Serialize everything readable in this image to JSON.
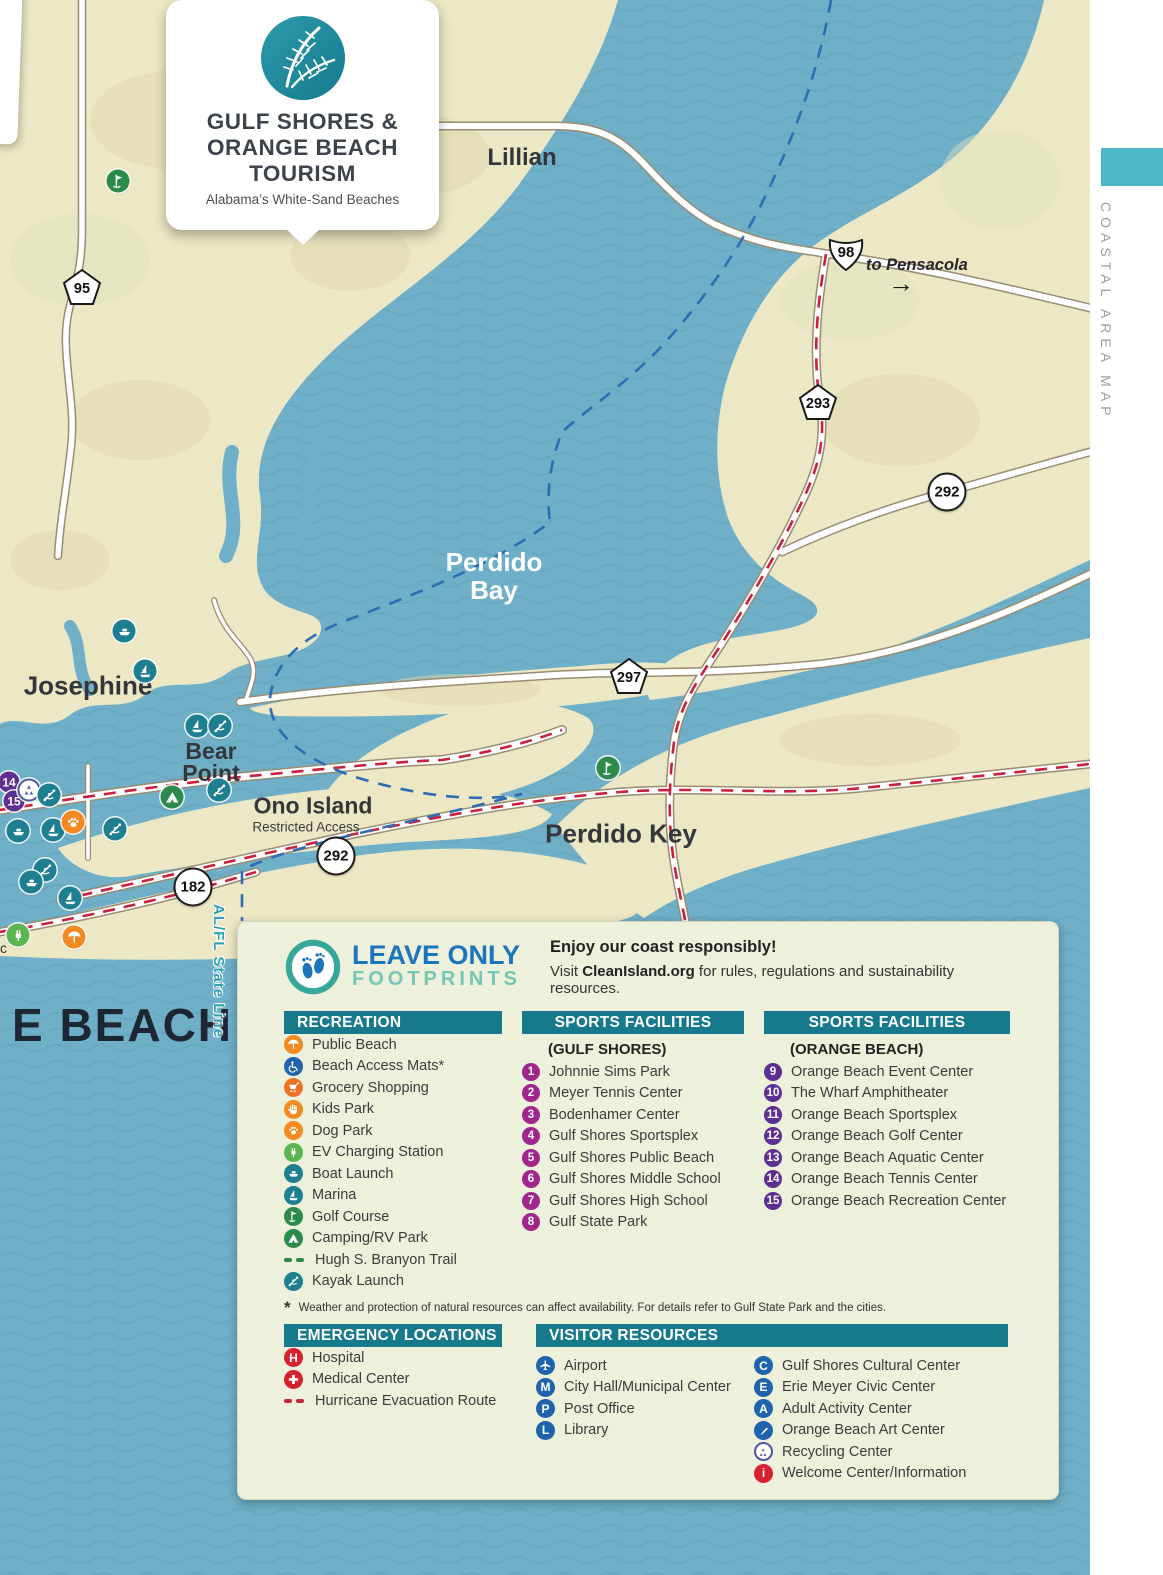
{
  "side": {
    "label": "COASTAL AREA MAP"
  },
  "badge": {
    "line1": "GULF SHORES &",
    "line2": "ORANGE BEACH",
    "line3": "TOURISM",
    "subtitle": "Alabama’s White-Sand Beaches"
  },
  "map": {
    "labels": {
      "lillian": "Lillian",
      "to_pensacola": "to Pensacola",
      "arrow": "→",
      "perdido_bay_1": "Perdido",
      "perdido_bay_2": "Bay",
      "josephine": "Josephine",
      "bear_1": "Bear",
      "bear_2": "Point",
      "ono": "Ono Island",
      "ono_sub": "Restricted Access",
      "perdido_key": "Perdido Key",
      "beach_partial": "E BEACH",
      "state_line": "AL/FL State Line",
      "partial_c": "c"
    },
    "shields": {
      "s95": "95",
      "s98": "98",
      "s293": "293",
      "s292a": "292",
      "s297": "297",
      "s292b": "292",
      "s182": "182"
    },
    "markers": {
      "m14": "14",
      "m15": "15"
    }
  },
  "legend": {
    "brand": {
      "line1": "LEAVE ONLY",
      "line2": "FOOTPRINTS"
    },
    "intro": {
      "bold": "Enjoy our coast responsibly!",
      "pre": "Visit ",
      "link": "CleanIsland.org",
      "post": " for rules, regulations and sustainability resources."
    },
    "recreation": {
      "title": "RECREATION",
      "items": [
        {
          "icon": "public-beach",
          "label": "Public Beach"
        },
        {
          "icon": "beach-access-mats",
          "label": "Beach Access Mats*"
        },
        {
          "icon": "grocery-shopping",
          "label": "Grocery Shopping"
        },
        {
          "icon": "kids-park",
          "label": "Kids Park"
        },
        {
          "icon": "dog-park",
          "label": "Dog Park"
        },
        {
          "icon": "ev-charging",
          "label": "EV Charging Station"
        },
        {
          "icon": "boat-launch",
          "label": "Boat Launch"
        },
        {
          "icon": "marina",
          "label": "Marina"
        },
        {
          "icon": "golf-course",
          "label": "Golf Course"
        },
        {
          "icon": "camping-rv",
          "label": "Camping/RV Park"
        },
        {
          "icon": "trail-dashes",
          "label": "Hugh S. Branyon Trail"
        },
        {
          "icon": "kayak-launch",
          "label": "Kayak Launch"
        }
      ]
    },
    "gulf_shores": {
      "title": "SPORTS FACILITIES",
      "subtitle": "(GULF SHORES)",
      "items": [
        {
          "num": "1",
          "label": "Johnnie Sims Park"
        },
        {
          "num": "2",
          "label": "Meyer Tennis Center"
        },
        {
          "num": "3",
          "label": "Bodenhamer Center"
        },
        {
          "num": "4",
          "label": "Gulf Shores Sportsplex"
        },
        {
          "num": "5",
          "label": "Gulf Shores Public Beach"
        },
        {
          "num": "6",
          "label": "Gulf Shores Middle School"
        },
        {
          "num": "7",
          "label": "Gulf Shores High School"
        },
        {
          "num": "8",
          "label": "Gulf State Park"
        }
      ]
    },
    "orange_beach": {
      "title": "SPORTS FACILITIES",
      "subtitle": "(ORANGE BEACH)",
      "items": [
        {
          "num": "9",
          "label": "Orange Beach Event Center"
        },
        {
          "num": "10",
          "label": "The Wharf Amphitheater"
        },
        {
          "num": "11",
          "label": "Orange Beach Sportsplex"
        },
        {
          "num": "12",
          "label": "Orange Beach Golf Center"
        },
        {
          "num": "13",
          "label": "Orange Beach Aquatic Center"
        },
        {
          "num": "14",
          "label": "Orange Beach Tennis Center"
        },
        {
          "num": "15",
          "label": "Orange Beach Recreation Center"
        }
      ]
    },
    "footnote": {
      "mark": "*",
      "text": "Weather and protection of natural resources can affect availability. For details refer to Gulf State Park and the cities."
    },
    "emergency": {
      "title": "EMERGENCY LOCATIONS",
      "items": [
        {
          "icon": "hospital",
          "letter": "H",
          "label": "Hospital"
        },
        {
          "icon": "medical-center",
          "label": "Medical Center"
        },
        {
          "icon": "hurricane-route",
          "label": "Hurricane Evacuation Route"
        }
      ]
    },
    "visitor": {
      "title": "VISITOR RESOURCES",
      "col1": [
        {
          "icon": "airport",
          "label": "Airport"
        },
        {
          "icon": "city-hall",
          "letter": "M",
          "label": "City Hall/Municipal Center"
        },
        {
          "icon": "post-office",
          "letter": "P",
          "label": "Post Office"
        },
        {
          "icon": "library",
          "letter": "L",
          "label": "Library"
        }
      ],
      "col2": [
        {
          "icon": "cultural-center",
          "letter": "C",
          "label": "Gulf Shores Cultural Center"
        },
        {
          "icon": "civic-center",
          "letter": "E",
          "label": "Erie Meyer Civic Center"
        },
        {
          "icon": "adult-activity",
          "letter": "A",
          "label": "Adult Activity Center"
        },
        {
          "icon": "art-center",
          "label": "Orange Beach Art Center"
        },
        {
          "icon": "recycling-center",
          "label": "Recycling Center"
        },
        {
          "icon": "welcome-info",
          "letter": "i",
          "label": "Welcome Center/Information"
        }
      ]
    }
  },
  "colors": {
    "water": "#6fb0c8",
    "land": "#ece7c4",
    "teal_header": "#17798c",
    "magenta": "#a0268e",
    "purple": "#5c2f91",
    "blue": "#1f63ad",
    "red": "#d6212f",
    "orange": "#f28a21",
    "green": "#2c8a4b",
    "teal_icon": "#1d7f8f",
    "accent_teal_block": "#4db9c7"
  }
}
